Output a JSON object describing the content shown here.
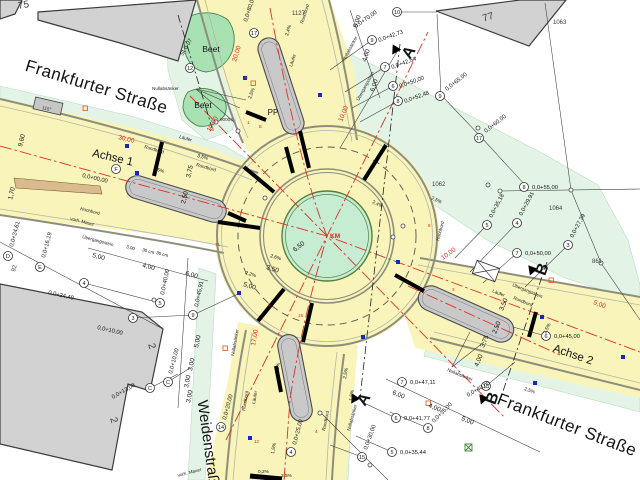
{
  "colors": {
    "road_yellow": "#f8f4ba",
    "verge_green": "#e3f4e6",
    "beet_green": "#a9e2b2",
    "center_island_green": "#c6ecd2",
    "building_gray": "#d2d2d2",
    "island_gray": "#c9c9c9",
    "axis_red": "#e03126",
    "drain_blue": "#1626c8"
  },
  "annotations": [
    {
      "n": "street-frankfurter-nw",
      "t": "Frankfurter Straße",
      "x": 95,
      "y": 92,
      "r": 17,
      "c": "street"
    },
    {
      "n": "street-frankfurter-se",
      "t": "Frankfurter Straße",
      "x": 565,
      "y": 430,
      "r": 21,
      "c": "street"
    },
    {
      "n": "street-weidenstrasse",
      "t": "Weidenstraße",
      "x": 204,
      "y": 447,
      "r": 82,
      "c": "street2"
    },
    {
      "n": "axis-1-label",
      "t": "Achse 1",
      "x": 112,
      "y": 161,
      "r": 13,
      "c": "axis"
    },
    {
      "n": "axis-2-label",
      "t": "Achse 2",
      "x": 572,
      "y": 358,
      "r": 19,
      "c": "axis"
    },
    {
      "n": "section-a-top",
      "t": "A",
      "x": 413,
      "y": 55,
      "r": -58,
      "c": "section"
    },
    {
      "n": "section-a-bottom",
      "t": "A",
      "x": 368,
      "y": 402,
      "r": -58,
      "c": "section"
    },
    {
      "n": "section-b-top",
      "t": "B",
      "x": 547,
      "y": 271,
      "r": -70,
      "c": "section"
    },
    {
      "n": "section-b-bottom",
      "t": "B",
      "x": 497,
      "y": 400,
      "r": -70,
      "c": "section"
    },
    {
      "n": "house-number",
      "t": "75",
      "x": 24,
      "y": 8,
      "r": -10,
      "c": "bignum"
    },
    {
      "n": "house-number",
      "t": "77",
      "x": 489,
      "y": 20,
      "r": -17,
      "c": "bignum"
    },
    {
      "n": "house-number",
      "t": "2",
      "x": 149,
      "y": 347,
      "r": 73,
      "c": "bignum"
    },
    {
      "n": "house-number",
      "t": "2",
      "x": 111,
      "y": 421,
      "r": 73,
      "c": "bignum"
    },
    {
      "n": "parcel-number",
      "t": "1063",
      "x": 553,
      "y": 24,
      "r": 0,
      "c": "parcel"
    },
    {
      "n": "parcel-number",
      "t": "1127",
      "x": 292,
      "y": 15,
      "r": 0,
      "c": "parcel"
    },
    {
      "n": "parcel-number",
      "t": "1062",
      "x": 432,
      "y": 186,
      "r": 0,
      "c": "parcel"
    },
    {
      "n": "parcel-number",
      "t": "1064",
      "x": 549,
      "y": 210,
      "r": 0,
      "c": "parcel"
    },
    {
      "n": "parcel-number",
      "t": "861",
      "x": 592,
      "y": 263,
      "r": 0,
      "c": "parcel"
    },
    {
      "n": "parcel-number",
      "t": "92",
      "x": 15,
      "y": 272,
      "r": -75,
      "c": "parcel"
    },
    {
      "n": "beet-label",
      "t": "Beet",
      "x": 211,
      "y": 52,
      "r": 0,
      "c": "beetlbl"
    },
    {
      "n": "beet-label",
      "t": "Beet",
      "x": 203,
      "y": 108,
      "r": 0,
      "c": "beetlbl"
    },
    {
      "n": "pp-label",
      "t": "PP",
      "x": 273,
      "y": 115,
      "r": 0,
      "c": "pp"
    },
    {
      "n": "point-number",
      "t": "90004",
      "x": 220,
      "y": 121,
      "r": 0,
      "c": "smallg"
    },
    {
      "n": "center-km-label",
      "t": "KM",
      "x": 330,
      "y": 238,
      "r": 0,
      "c": "km"
    },
    {
      "n": "pad-label",
      "t": "115°",
      "x": 42,
      "y": 109,
      "r": 13,
      "c": "smallg"
    },
    {
      "n": "dim-label",
      "t": "6,50",
      "x": 295,
      "y": 252,
      "r": -38,
      "c": "dim"
    },
    {
      "n": "dim-label",
      "t": "3,50",
      "x": 266,
      "y": 269,
      "r": 17,
      "c": "dim"
    },
    {
      "n": "dim-label",
      "t": "5,00",
      "x": 243,
      "y": 286,
      "r": 17,
      "c": "dim"
    },
    {
      "n": "dim-label",
      "t": "3,75",
      "x": 190,
      "y": 178,
      "r": -76,
      "c": "dim"
    },
    {
      "n": "dim-label",
      "t": "2,50",
      "x": 185,
      "y": 204,
      "r": -76,
      "c": "dim"
    },
    {
      "n": "dim-label",
      "t": "5,00",
      "x": 92,
      "y": 257,
      "r": 15,
      "c": "dim"
    },
    {
      "n": "dim-label",
      "t": "4,00",
      "x": 142,
      "y": 267,
      "r": 15,
      "c": "dim"
    },
    {
      "n": "dim-label",
      "t": "6,00",
      "x": 185,
      "y": 275,
      "r": 15,
      "c": "dim"
    },
    {
      "n": "dim-label",
      "t": "3,00",
      "x": 126,
      "y": 248,
      "r": 15,
      "c": "dimsm"
    },
    {
      "n": "dim-label",
      "t": "30 cm",
      "x": 142,
      "y": 251,
      "r": 15,
      "c": "dimsm"
    },
    {
      "n": "dim-label",
      "t": "30 cm",
      "x": 156,
      "y": 254,
      "r": 15,
      "c": "dimsm"
    },
    {
      "n": "dim-label",
      "t": "9,60",
      "x": 22,
      "y": 147,
      "r": -76,
      "c": "dim"
    },
    {
      "n": "dim-label",
      "t": "1,70",
      "x": 12,
      "y": 200,
      "r": -76,
      "c": "dim"
    },
    {
      "n": "dim-label",
      "t": "5,00",
      "x": 198,
      "y": 348,
      "r": -78,
      "c": "dim"
    },
    {
      "n": "dim-label",
      "t": "3,00",
      "x": 192,
      "y": 371,
      "r": -78,
      "c": "dim"
    },
    {
      "n": "dim-label",
      "t": "3,00",
      "x": 188,
      "y": 388,
      "r": -78,
      "c": "dim"
    },
    {
      "n": "dim-label",
      "t": "3,00",
      "x": 190,
      "y": 403,
      "r": -78,
      "c": "dim"
    },
    {
      "n": "dim-label",
      "t": "5,00",
      "x": 357,
      "y": 28,
      "r": -72,
      "c": "dim"
    },
    {
      "n": "dim-label",
      "t": "4,00",
      "x": 366,
      "y": 62,
      "r": -72,
      "c": "dim"
    },
    {
      "n": "dim-label",
      "t": "6,00",
      "x": 374,
      "y": 92,
      "r": -72,
      "c": "dim"
    },
    {
      "n": "dim-label",
      "t": "6,00",
      "x": 392,
      "y": 394,
      "r": 22,
      "c": "dim"
    },
    {
      "n": "dim-label",
      "t": "4,00",
      "x": 428,
      "y": 407,
      "r": 22,
      "c": "dim"
    },
    {
      "n": "dim-label",
      "t": "5,00",
      "x": 461,
      "y": 420,
      "r": 22,
      "c": "dim"
    },
    {
      "n": "dim-label",
      "t": "3,50",
      "x": 503,
      "y": 311,
      "r": -68,
      "c": "dim"
    },
    {
      "n": "dim-label",
      "t": "2,50",
      "x": 496,
      "y": 334,
      "r": -68,
      "c": "dim"
    },
    {
      "n": "dim-label",
      "t": "3,75",
      "x": 484,
      "y": 348,
      "r": -68,
      "c": "dim"
    },
    {
      "n": "dim-label",
      "t": "4,00",
      "x": 478,
      "y": 367,
      "r": -68,
      "c": "dim"
    },
    {
      "n": "red-dim-label",
      "t": "30,00",
      "x": 118,
      "y": 139,
      "r": 14,
      "c": "dimred"
    },
    {
      "n": "red-dim-label",
      "t": "20,00",
      "x": 236,
      "y": 62,
      "r": -73,
      "c": "dimred"
    },
    {
      "n": "red-dim-label",
      "t": "17,00",
      "x": 255,
      "y": 346,
      "r": -80,
      "c": "dimred"
    },
    {
      "n": "red-dim-label",
      "t": "10,00",
      "x": 342,
      "y": 122,
      "r": -68,
      "c": "dimred"
    },
    {
      "n": "red-dim-label",
      "t": "10,00",
      "x": 443,
      "y": 260,
      "r": -36,
      "c": "dimred"
    },
    {
      "n": "red-dim-label",
      "t": "10,00",
      "x": 210,
      "y": 132,
      "r": -60,
      "c": "dimred"
    },
    {
      "n": "red-dim-label",
      "t": "5,00",
      "x": 593,
      "y": 304,
      "r": 20,
      "c": "dimred"
    },
    {
      "n": "slope-label",
      "t": "2,5%",
      "x": 153,
      "y": 170,
      "r": 15,
      "c": "slope"
    },
    {
      "n": "slope-label",
      "t": "3,5%",
      "x": 197,
      "y": 157,
      "r": 15,
      "c": "slope"
    },
    {
      "n": "slope-label",
      "t": "2,5%",
      "x": 251,
      "y": 99,
      "r": -70,
      "c": "slope"
    },
    {
      "n": "slope-label",
      "t": "2,4%",
      "x": 288,
      "y": 36,
      "r": -72,
      "c": "slope"
    },
    {
      "n": "slope-label",
      "t": "2,4%",
      "x": 372,
      "y": 203,
      "r": 25,
      "c": "slope"
    },
    {
      "n": "slope-label",
      "t": "2,5%",
      "x": 431,
      "y": 199,
      "r": 25,
      "c": "slope"
    },
    {
      "n": "slope-label",
      "t": "2,2%",
      "x": 245,
      "y": 274,
      "r": 17,
      "c": "slope"
    },
    {
      "n": "slope-label",
      "t": "2,6%",
      "x": 270,
      "y": 257,
      "r": 17,
      "c": "slope"
    },
    {
      "n": "slope-label",
      "t": "2,5%",
      "x": 546,
      "y": 334,
      "r": -65,
      "c": "slope"
    },
    {
      "n": "slope-label",
      "t": "2,5%",
      "x": 524,
      "y": 390,
      "r": 20,
      "c": "slope"
    },
    {
      "n": "slope-label",
      "t": "2,5%",
      "x": 278,
      "y": 374,
      "r": -80,
      "c": "slope"
    },
    {
      "n": "slope-label",
      "t": "2,5%",
      "x": 346,
      "y": 379,
      "r": -80,
      "c": "slope"
    },
    {
      "n": "slope-label",
      "t": "1,5%",
      "x": 352,
      "y": 401,
      "r": -80,
      "c": "slope"
    },
    {
      "n": "slope-label",
      "t": "0,2%",
      "x": 258,
      "y": 473,
      "r": 0,
      "c": "slope"
    },
    {
      "n": "slope-label",
      "t": "2,5%",
      "x": 281,
      "y": 477,
      "r": 0,
      "c": "slope"
    },
    {
      "n": "slope-label",
      "t": "1,5%",
      "x": 274,
      "y": 454,
      "r": -80,
      "c": "slope"
    },
    {
      "n": "small-label",
      "t": "Nullabsänker",
      "x": 152,
      "y": 90,
      "r": 0,
      "c": "small"
    },
    {
      "n": "small-label",
      "t": "Nullabsänker",
      "x": 345,
      "y": 61,
      "r": -62,
      "c": "small"
    },
    {
      "n": "small-label",
      "t": "Nullabsänker",
      "x": 234,
      "y": 356,
      "r": -80,
      "c": "small"
    },
    {
      "n": "small-label",
      "t": "Nullabsänker",
      "x": 350,
      "y": 431,
      "r": -75,
      "c": "small"
    },
    {
      "n": "small-label",
      "t": "Nullabsänker",
      "x": 447,
      "y": 371,
      "r": 22,
      "c": "small"
    },
    {
      "n": "small-label",
      "t": "Übergangsstein",
      "x": 82,
      "y": 238,
      "r": 15,
      "c": "small"
    },
    {
      "n": "small-label",
      "t": "Übergangsstein",
      "x": 359,
      "y": 101,
      "r": -62,
      "c": "small"
    },
    {
      "n": "small-label",
      "t": "Übergangsstein",
      "x": 512,
      "y": 286,
      "r": 22,
      "c": "small"
    },
    {
      "n": "small-label",
      "t": "Hochbord",
      "x": 80,
      "y": 210,
      "r": 14,
      "c": "small"
    },
    {
      "n": "small-label",
      "t": "Hochbord",
      "x": 439,
      "y": 241,
      "r": -75,
      "c": "small"
    },
    {
      "n": "small-label",
      "t": "Rundbord",
      "x": 144,
      "y": 148,
      "r": 16,
      "c": "small"
    },
    {
      "n": "small-label",
      "t": "Rundbord",
      "x": 196,
      "y": 166,
      "r": 16,
      "c": "small"
    },
    {
      "n": "small-label",
      "t": "Rundbord",
      "x": 303,
      "y": 24,
      "r": -72,
      "c": "small"
    },
    {
      "n": "small-label",
      "t": "Rundbord",
      "x": 513,
      "y": 299,
      "r": 22,
      "c": "small"
    },
    {
      "n": "small-label",
      "t": "Rundbord",
      "x": 245,
      "y": 411,
      "r": -80,
      "c": "small"
    },
    {
      "n": "small-label",
      "t": "Rundbord",
      "x": 325,
      "y": 431,
      "r": -78,
      "c": "small"
    },
    {
      "n": "small-label",
      "t": "Läufer",
      "x": 179,
      "y": 138,
      "r": 16,
      "c": "small"
    },
    {
      "n": "small-label",
      "t": "Läufer",
      "x": 292,
      "y": 67,
      "r": -72,
      "c": "small"
    },
    {
      "n": "small-label",
      "t": "Läufer",
      "x": 492,
      "y": 292,
      "r": 22,
      "c": "small"
    },
    {
      "n": "small-label",
      "t": "Läufer",
      "x": 255,
      "y": 404,
      "r": -80,
      "c": "small"
    },
    {
      "n": "small-label",
      "t": "vorh. Mauer",
      "x": 70,
      "y": 220,
      "r": 14,
      "c": "small"
    },
    {
      "n": "small-label",
      "t": "vorh. Mauer",
      "x": 178,
      "y": 477,
      "r": -15,
      "c": "small"
    },
    {
      "n": "red-point-label",
      "t": "9",
      "x": 245,
      "y": 79,
      "r": 0,
      "c": "redpt"
    },
    {
      "n": "red-point-label",
      "t": "E",
      "x": 259,
      "y": 128,
      "r": 0,
      "c": "redpt"
    },
    {
      "n": "red-point-label",
      "t": "8",
      "x": 428,
      "y": 227,
      "r": 0,
      "c": "redpt"
    },
    {
      "n": "red-point-label",
      "t": "3",
      "x": 452,
      "y": 291,
      "r": 0,
      "c": "redpt"
    },
    {
      "n": "red-point-label",
      "t": "15",
      "x": 298,
      "y": 317,
      "r": 0,
      "c": "redpt"
    },
    {
      "n": "red-point-label",
      "t": "4",
      "x": 315,
      "y": 433,
      "r": 0,
      "c": "redpt"
    },
    {
      "n": "red-point-label",
      "t": "12",
      "x": 254,
      "y": 443,
      "r": 0,
      "c": "redpt"
    },
    {
      "n": "red-point-label",
      "t": "6",
      "x": 268,
      "y": 306,
      "r": 0,
      "c": "redpt"
    },
    {
      "n": "red-point-label",
      "t": "71",
      "x": 215,
      "y": 246,
      "r": 0,
      "c": "redpt"
    },
    {
      "n": "red-point-label",
      "t": "16",
      "x": 209,
      "y": 131,
      "r": 0,
      "c": "redpt"
    },
    {
      "n": "red-point-label",
      "t": "1",
      "x": 247,
      "y": 124,
      "r": 0,
      "c": "redpt"
    }
  ],
  "stations": [
    {
      "id": "17",
      "st": "0,0+80,00",
      "cx": 254,
      "cy": 33,
      "tx": 247,
      "ty": 22,
      "tr": -72
    },
    {
      "id": "10",
      "st": "0,0+70,00",
      "cx": 397,
      "cy": 12,
      "tx": 356,
      "ty": 28,
      "tr": -35
    },
    {
      "id": "9",
      "st": "0,0+42,73",
      "cx": 372,
      "cy": 40,
      "tx": 379,
      "ty": 42,
      "tr": -20
    },
    {
      "id": "7",
      "st": "0,0+42,54",
      "cx": 385,
      "cy": 67,
      "tx": 392,
      "ty": 69,
      "tr": -20
    },
    {
      "id": "6",
      "st": "0,0+50,00",
      "cx": 393,
      "cy": 86,
      "tx": 400,
      "ty": 88,
      "tr": -20
    },
    {
      "id": "8",
      "st": "0,0+52,48",
      "cx": 398,
      "cy": 101,
      "tx": 405,
      "ty": 103,
      "tr": -20
    },
    {
      "id": "9",
      "st": "0,0+65,00",
      "cx": 440,
      "cy": 96,
      "tx": 447,
      "ty": 91,
      "tr": -38
    },
    {
      "id": "17",
      "st": "0,0+60,00",
      "cx": 479,
      "cy": 138,
      "tx": 486,
      "ty": 133,
      "tr": -38
    },
    {
      "id": "8",
      "st": "0,0+55,00",
      "cx": 524,
      "cy": 187,
      "tx": 532,
      "ty": 189,
      "tr": 0
    },
    {
      "id": "5",
      "st": "0,0+35,18",
      "cx": 487,
      "cy": 225,
      "tx": 492,
      "ty": 218,
      "tr": -62
    },
    {
      "id": "4",
      "st": "0,0+29,91",
      "cx": 517,
      "cy": 223,
      "tx": 522,
      "ty": 216,
      "tr": -62
    },
    {
      "id": "3",
      "st": "0,0+27,39",
      "cx": 568,
      "cy": 245,
      "tx": 573,
      "ty": 238,
      "tr": -62
    },
    {
      "id": "7",
      "st": "0,0+50,00",
      "cx": 517,
      "cy": 253,
      "tx": 525,
      "ty": 255,
      "tr": 0
    },
    {
      "id": "6",
      "st": "0,0+45,00",
      "cx": 546,
      "cy": 336,
      "tx": 554,
      "ty": 338,
      "tr": 0
    },
    {
      "id": "7",
      "st": "0,0+47,11",
      "cx": 402,
      "cy": 382,
      "tx": 410,
      "ty": 384,
      "tr": 0
    },
    {
      "id": "6",
      "st": "0,0+41,77",
      "cx": 396,
      "cy": 418,
      "tx": 404,
      "ty": 420,
      "tr": 0
    },
    {
      "id": "8",
      "st": "0,0+35,00",
      "cx": 428,
      "cy": 428,
      "tx": 434,
      "ty": 423,
      "tr": -45
    },
    {
      "id": "5",
      "st": "0,0+35,44",
      "cx": 392,
      "cy": 452,
      "tx": 400,
      "ty": 454,
      "tr": 0
    },
    {
      "id": "15",
      "st": "0,0+30,00",
      "cx": 362,
      "cy": 457,
      "tx": 367,
      "ty": 450,
      "tr": -70
    },
    {
      "id": "4",
      "st": "0,0+25,00",
      "cx": 291,
      "cy": 452,
      "tx": 296,
      "ty": 445,
      "tr": -75
    },
    {
      "id": "14",
      "st": "0,0+20,00",
      "cx": 221,
      "cy": 427,
      "tx": 226,
      "ty": 420,
      "tr": -75
    },
    {
      "id": "C",
      "st": "0,0+13,08",
      "cx": 150,
      "cy": 388,
      "tx": 113,
      "ty": 399,
      "tr": -30
    },
    {
      "id": "C",
      "st": "0,0+10,00",
      "cx": 168,
      "cy": 382,
      "tx": 172,
      "ty": 374,
      "tr": -75
    },
    {
      "id": "E",
      "st": "0,0+16,19",
      "cx": 40,
      "cy": 267,
      "tx": 45,
      "ty": 258,
      "tr": -75
    },
    {
      "id": "D",
      "st": "0,0+24,61",
      "cx": 8,
      "cy": 256,
      "tx": 13,
      "ty": 247,
      "tr": -75
    },
    {
      "id": "F",
      "st": "0,0+00,00",
      "cx": 116,
      "cy": 169,
      "tx": 82,
      "ty": 177,
      "tr": 13
    },
    {
      "id": "9",
      "st": "0,0+45,91",
      "cx": 193,
      "cy": 315,
      "tx": 198,
      "ty": 307,
      "tr": -78
    },
    {
      "id": "4",
      "st": "0,0+24,49",
      "cx": 84,
      "cy": 283,
      "tx": 48,
      "ty": 294,
      "tr": 13
    },
    {
      "id": "3",
      "st": "0,0+10,00",
      "cx": 133,
      "cy": 318,
      "tx": 97,
      "ty": 329,
      "tr": 13
    },
    {
      "id": "5",
      "st": "0,0+40,00",
      "cx": 160,
      "cy": 303,
      "tx": 164,
      "ty": 295,
      "tr": -78
    },
    {
      "id": "12",
      "st": "St 0-07",
      "cx": 190,
      "cy": 68,
      "tx": 183,
      "ty": 56,
      "tr": -60
    },
    {
      "id": "13",
      "st": "0,0+40,00",
      "cx": 486,
      "cy": 386,
      "tx": 468,
      "ty": 397,
      "tr": -30
    }
  ]
}
